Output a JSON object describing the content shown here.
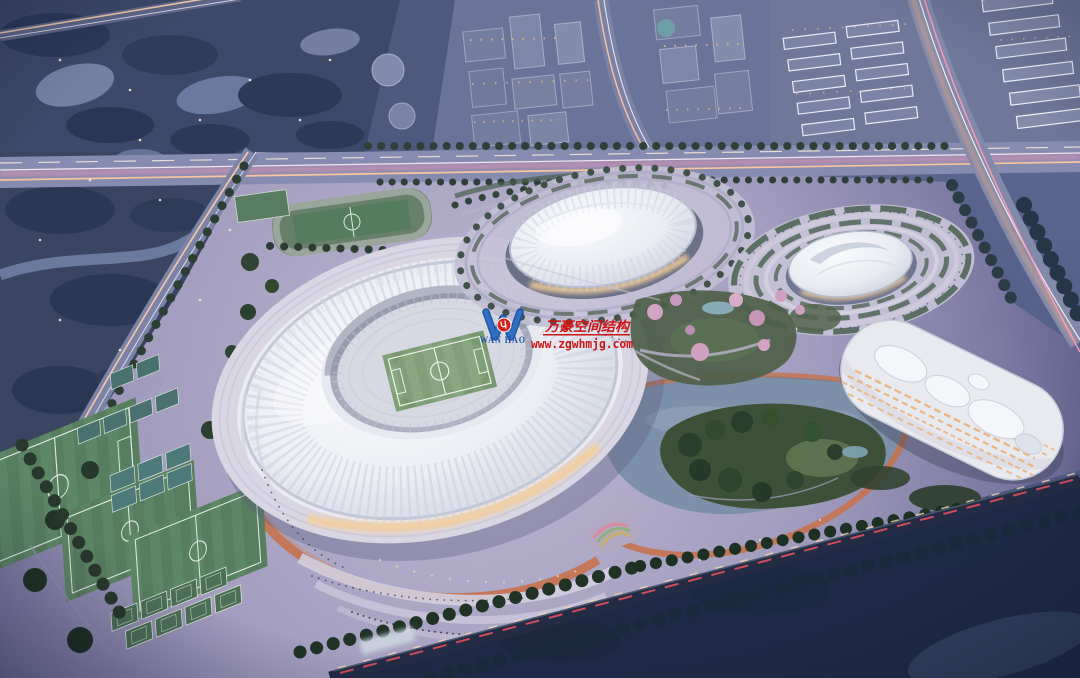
{
  "image": {
    "kind": "aerial dusk architectural rendering",
    "subject": "sports complex with stadium, gymnasium dome, aquatics dome, hotel, training fields, lake and city context"
  },
  "watermark": {
    "company_cn": "万豪空间结构",
    "website": "www.zgwhmjg.com",
    "logo": {
      "name": "WAN HAO"
    },
    "colors": {
      "red": "#cc1515",
      "blue": "#2f6fc4",
      "navy": "#1a4d9e"
    }
  },
  "palette": {
    "dusk_base": "#5e6a92",
    "wetland": "#3c4968",
    "roof_white": "#f2f3f7",
    "pitch_green": "#78996f",
    "track_orange": "#c5734f",
    "plaza_lavender": "#bdb7d2",
    "warm_glow": "#f2cc98",
    "trail_pink": "#ff93b4",
    "trail_orange": "#ffc79d",
    "night_park": "#1f2b46"
  },
  "scene": {
    "landmarks": [
      "main stadium with oval ribbed roof and football pitch",
      "gymnasium dome arena",
      "swirl-roof aquatics arena with terraced rings",
      "curved hotel block with lit ribbon windows",
      "lake with wooded island",
      "training soccer fields",
      "tennis and basketball courts",
      "orange running track loops",
      "expressway with light trails",
      "rail line through dark park",
      "wetland park",
      "city blocks and residential rows"
    ]
  }
}
